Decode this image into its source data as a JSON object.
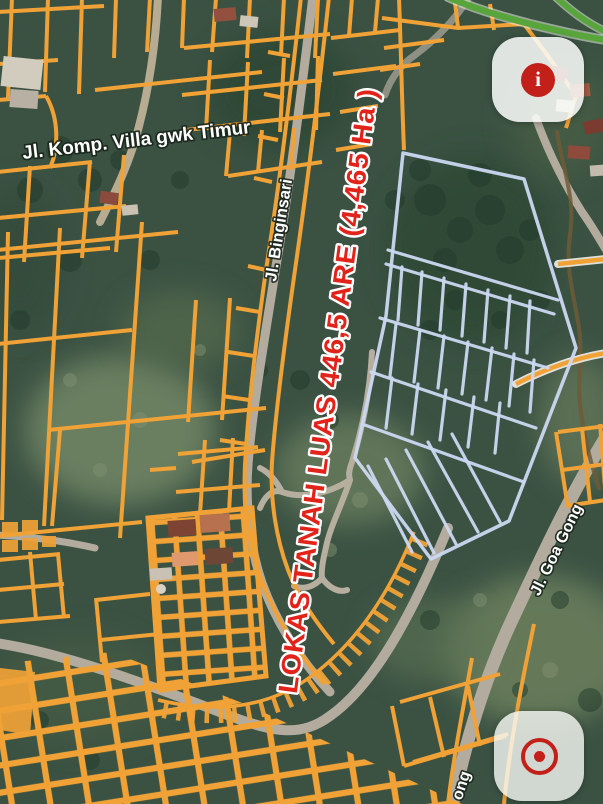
{
  "map": {
    "labels": {
      "street_top": "Jl. Komp. Villa gwk Timur",
      "street_binginsari": "Jl. Binginsari",
      "street_goa_gong": "Jl. Goa Gong",
      "street_goa_gong_partial": "ong",
      "land_banner": "LOKAS TANAH LUAS 446,5 ARE (4,465 Ha )"
    },
    "colors": {
      "parcel_line": "#F0A236",
      "road_gray": "#B2AB9E",
      "lane_gray": "#B6AE9E",
      "plot_outline_blue": "#CBD8F1",
      "banner_red": "#E2231A",
      "button_icon_red": "#C32019",
      "road_green": "#58A53C",
      "trail_brown": "#6E5B36"
    },
    "buttons": {
      "info": {
        "icon": "info-icon",
        "glyph": "i"
      },
      "locate": {
        "icon": "target-icon"
      }
    }
  }
}
